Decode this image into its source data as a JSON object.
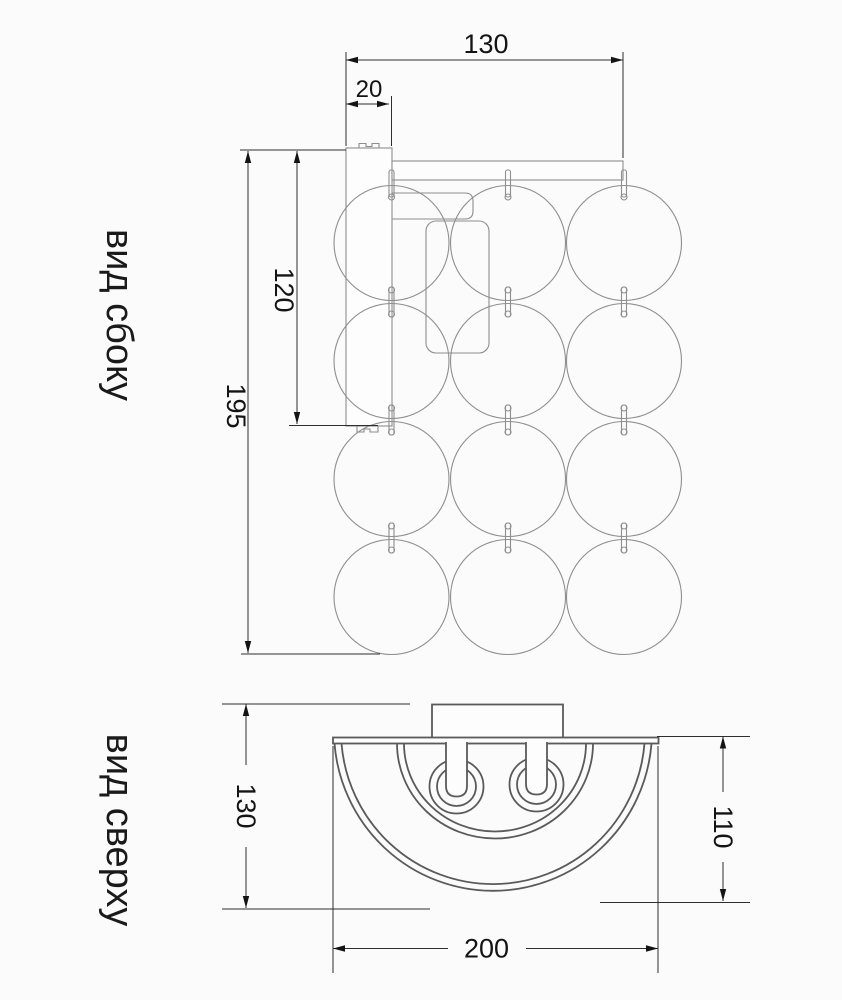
{
  "drawing": {
    "type": "technical-dimension-drawing",
    "subject": "wall-lamp with glass spheres"
  },
  "side_view": {
    "label": "вид сбоку",
    "dimensions": {
      "width": "130",
      "offset": "20",
      "plate_height": "120",
      "total_height": "195"
    }
  },
  "top_view": {
    "label": "вид сверху",
    "dimensions": {
      "depth": "130",
      "shade_depth": "110",
      "width": "200"
    }
  },
  "colors": {
    "background": "#fbfbfb",
    "geometry_light": "#8e8e8e",
    "geometry_dark": "#5a5a5a",
    "dimension_line": "#2e2e2e",
    "text": "#141414"
  }
}
